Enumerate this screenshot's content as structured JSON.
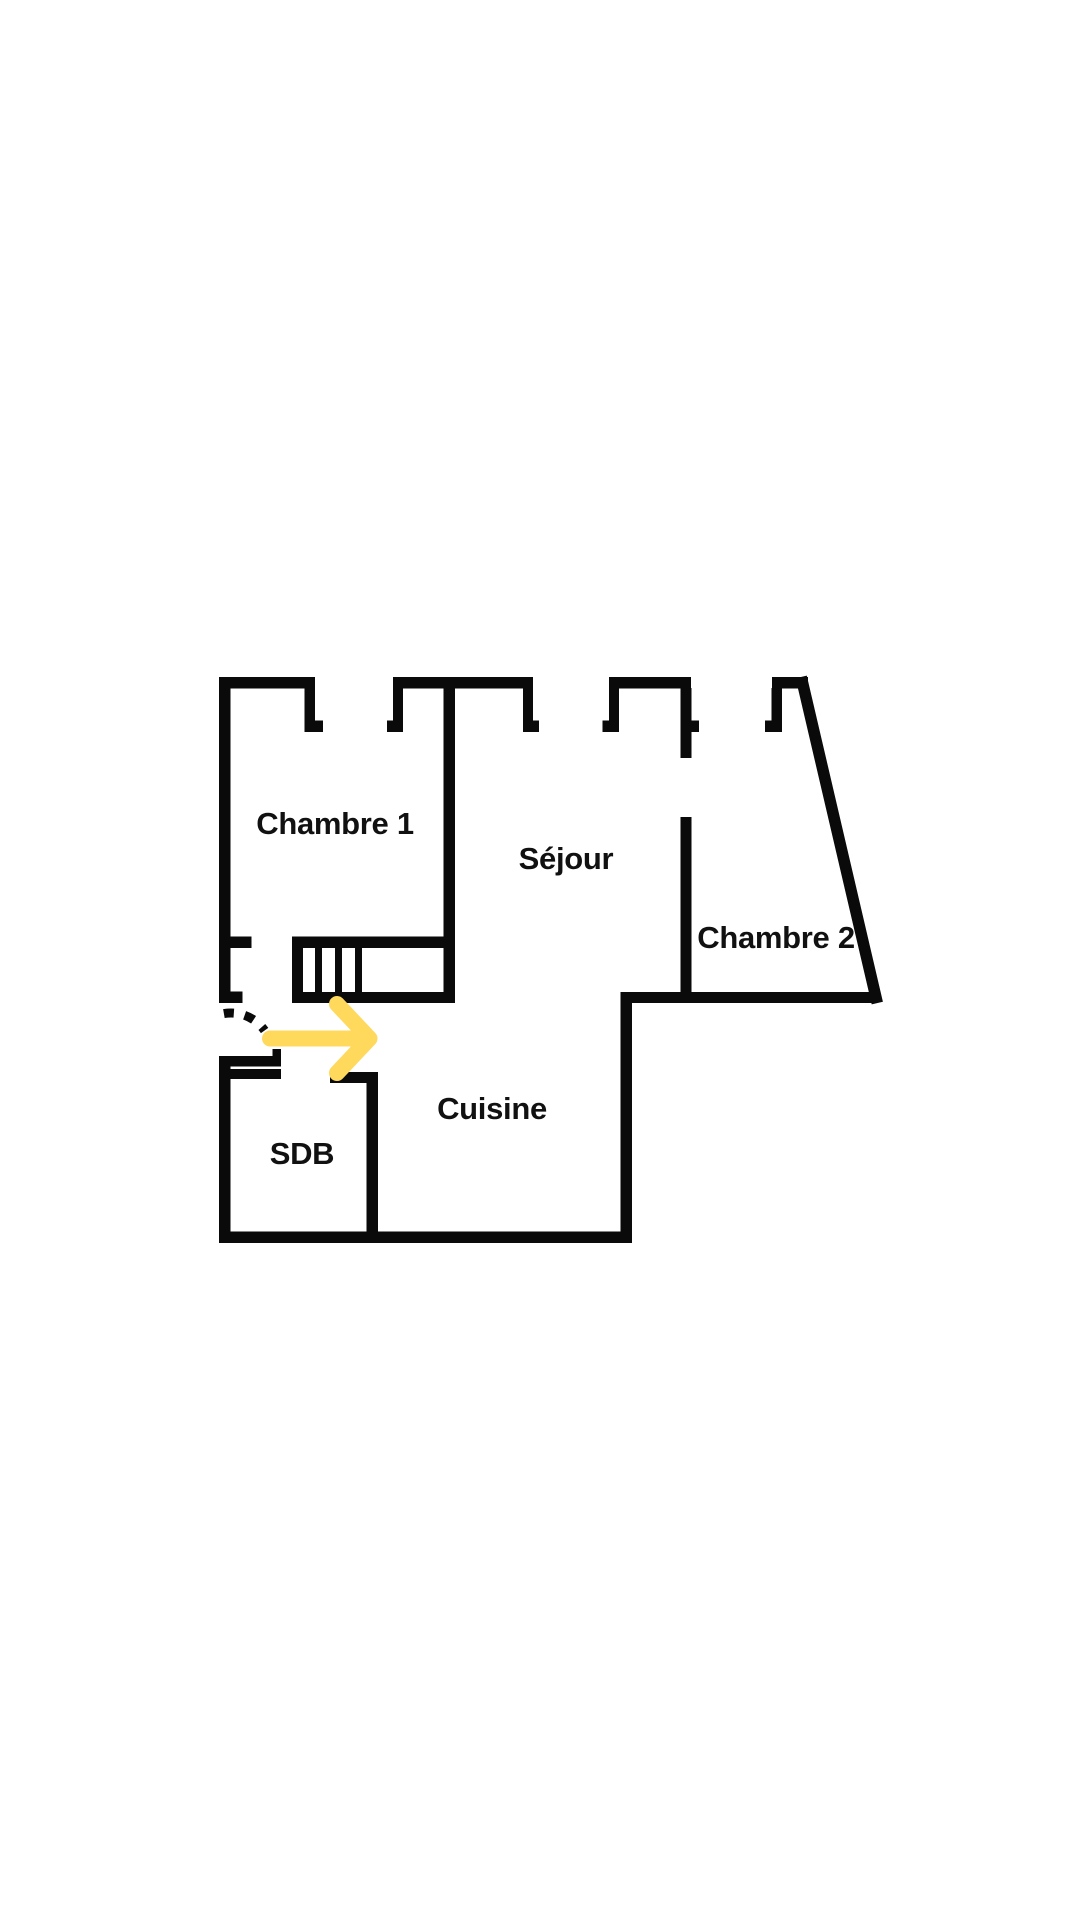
{
  "page": {
    "kind": "apartment-floor-plan",
    "background": "white"
  },
  "colors": {
    "wall": "#0a0a0a",
    "label": "#111111",
    "arrow": "#ffd95c",
    "background": "#ffffff"
  },
  "rooms": {
    "chambre1": {
      "label": "Chambre 1"
    },
    "sejour": {
      "label": "Séjour"
    },
    "chambre2": {
      "label": "Chambre 2"
    },
    "cuisine": {
      "label": "Cuisine"
    },
    "sdb": {
      "label": "SDB"
    }
  },
  "annotations": {
    "entrance_arrow_icon": "right-arrow-icon",
    "door_swing": "dashed-door-swing-arc",
    "stairs": "staircase-with-steps",
    "windows": [
      "window-opening-1",
      "window-opening-2",
      "window-opening-3"
    ]
  }
}
